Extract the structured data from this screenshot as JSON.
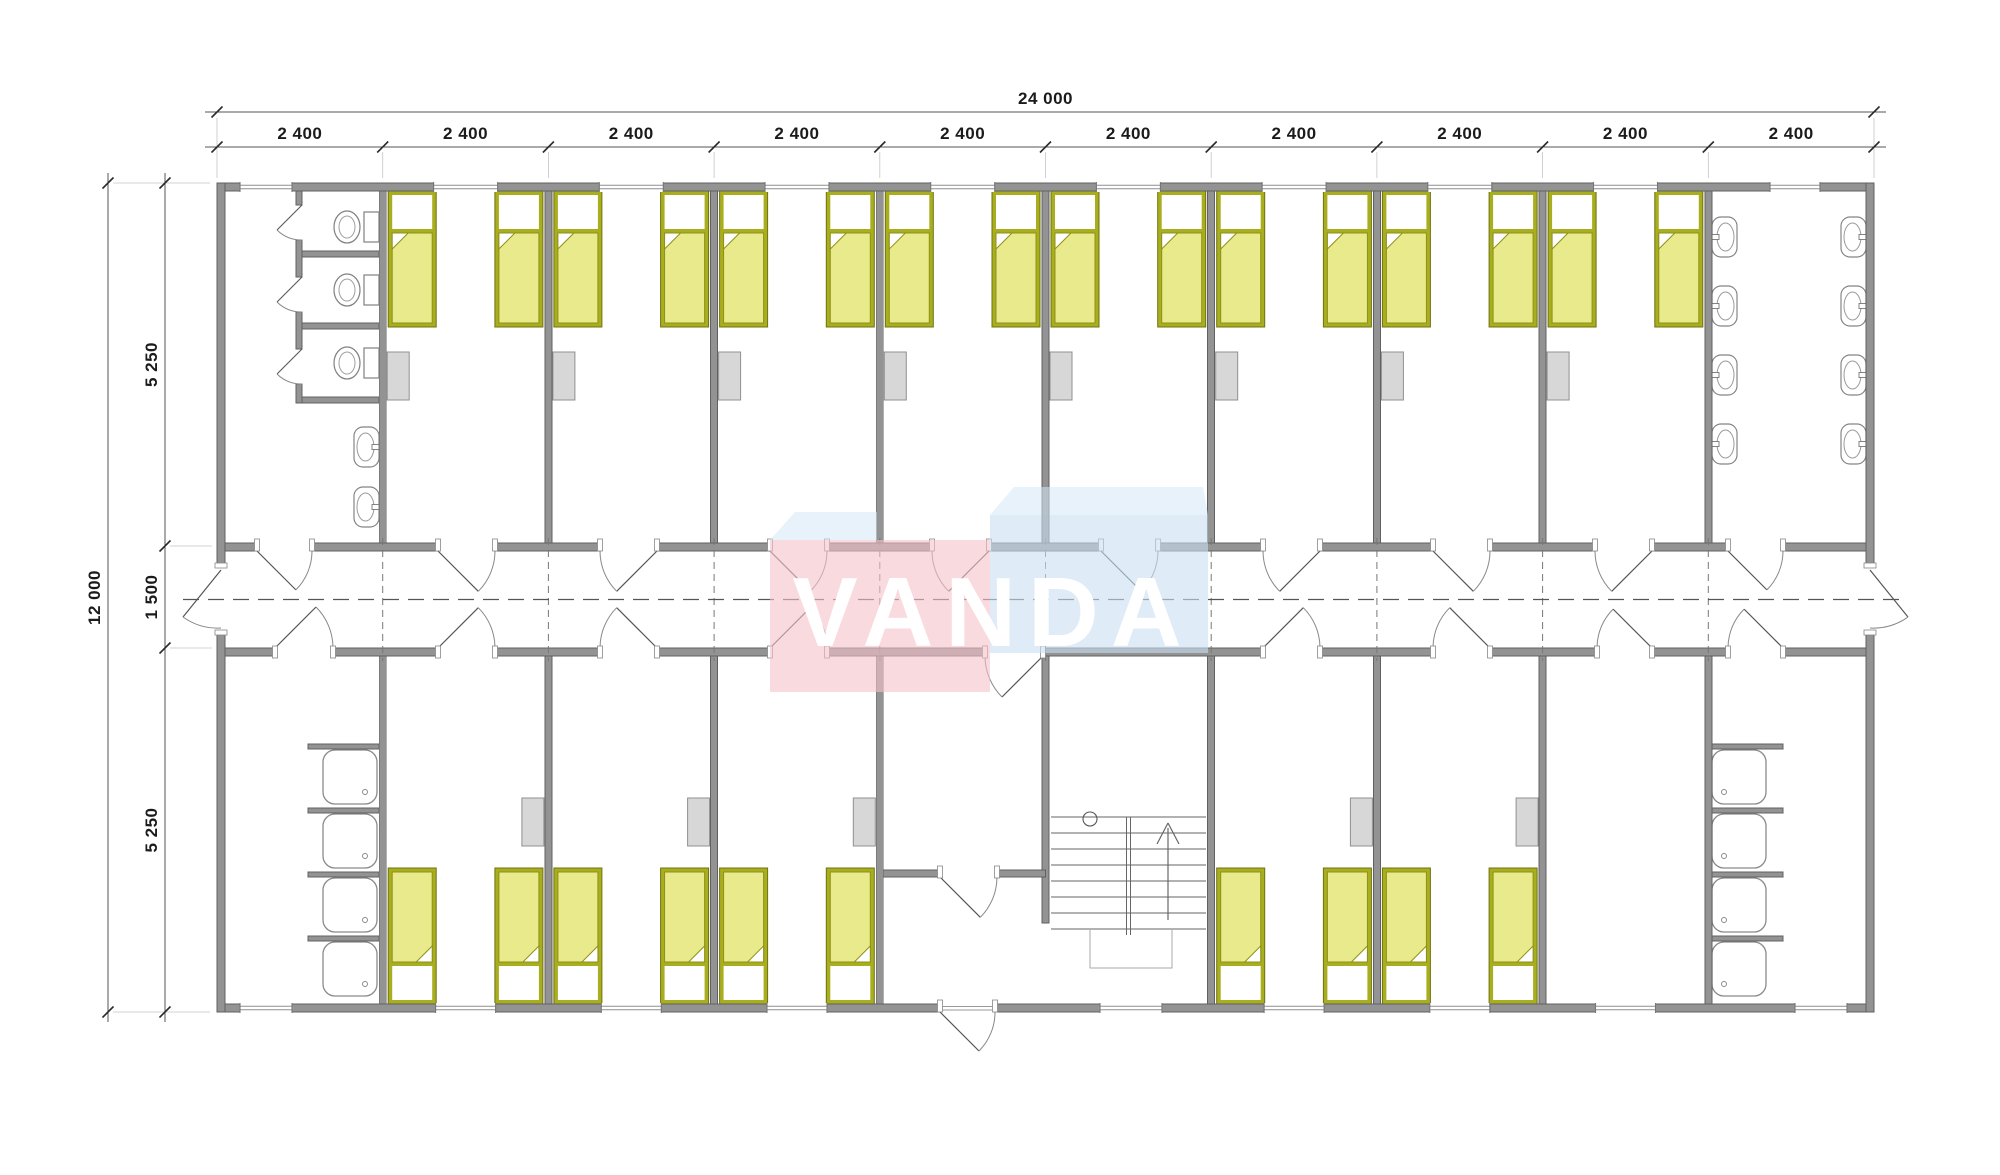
{
  "watermark": {
    "text": "VANDA",
    "pink_block_color": "#f5c2c9",
    "blue_block_color": "#c9e0f2",
    "top_face_color": "#d6e7f5"
  },
  "dimensions": {
    "top_total": "24 000",
    "top_segments": [
      "2 400",
      "2 400",
      "2 400",
      "2 400",
      "2 400",
      "2 400",
      "2 400",
      "2 400",
      "2 400",
      "2 400"
    ],
    "left_total": "12 000",
    "left_segments": [
      "5 250",
      "1 500",
      "5 250"
    ]
  },
  "plan_facts": {
    "overall_width_mm": 24000,
    "overall_depth_mm": 12000,
    "module_width_mm": 2400,
    "corridor_width_mm": 1500,
    "room_depth_mm": 5250,
    "bed_color": "#e9ea8c",
    "bed_frame_color": "#a9ae1e",
    "wall_color": "#939393"
  },
  "fixtures_counts": {
    "beds": 26,
    "wardrobes": 13,
    "toilets": 3,
    "wash_basins": 10,
    "shower_trays": 8,
    "stairwells": 1
  }
}
